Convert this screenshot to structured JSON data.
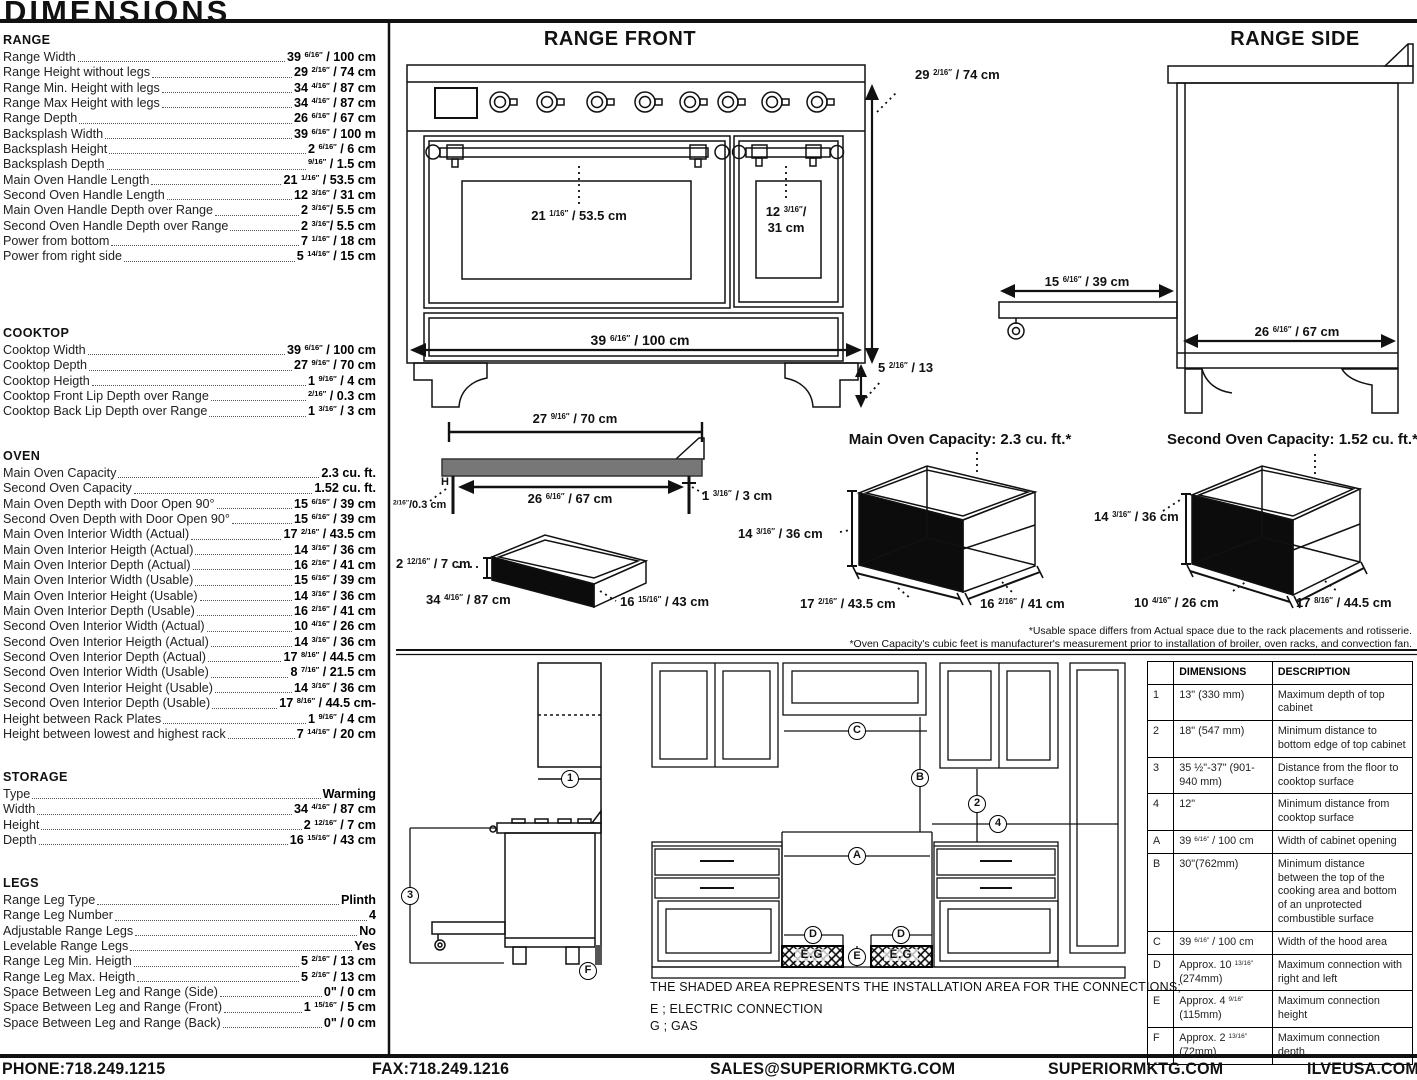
{
  "page": {
    "title": "DIMENSIONS"
  },
  "specs": {
    "sections": [
      {
        "title": "RANGE",
        "rows": [
          {
            "l": "Range Width",
            "v": "39 6/16″ / 100 cm"
          },
          {
            "l": "Range Height without legs",
            "v": "29 2/16″ / 74 cm"
          },
          {
            "l": "Range Min. Height with legs",
            "v": "34 4/16″ / 87 cm"
          },
          {
            "l": "Range Max Height with legs",
            "v": "34 4/16″ / 87 cm"
          },
          {
            "l": "Range Depth",
            "v": "26 6/16″ / 67 cm"
          },
          {
            "l": "Backsplash Width",
            "v": "39 6/16″ / 100 m"
          },
          {
            "l": "Backsplash Height",
            "v": "2 6/16″ / 6 cm"
          },
          {
            "l": "Backsplash Depth",
            "v": "9/16″ / 1.5 cm"
          },
          {
            "l": "Main Oven Handle Length",
            "v": "21 1/16″ / 53.5 cm"
          },
          {
            "l": "Second Oven Handle Length",
            "v": "12 3/16″ / 31 cm"
          },
          {
            "l": "Main Oven Handle Depth over Range",
            "v": "2 3/16″/ 5.5 cm"
          },
          {
            "l": "Second Oven Handle Depth over Range",
            "v": "2 3/16″/ 5.5 cm"
          },
          {
            "l": "Power from bottom",
            "v": "7 1/16″ / 18 cm"
          },
          {
            "l": "Power from right side",
            "v": "5 14/16″ / 15 cm"
          }
        ]
      },
      {
        "title": "COOKTOP",
        "rows": [
          {
            "l": "Cooktop Width",
            "v": "39 6/16″ / 100 cm"
          },
          {
            "l": "Cooktop Depth",
            "v": "27 9/16″ / 70 cm"
          },
          {
            "l": "Cooktop Heigth",
            "v": "1 9/16″ / 4 cm"
          },
          {
            "l": "Cooktop Front Lip Depth over Range",
            "v": "2/16″ / 0.3 cm"
          },
          {
            "l": "Cooktop Back Lip Depth over Range",
            "v": "1 3/16″ / 3 cm"
          }
        ]
      },
      {
        "title": "OVEN",
        "rows": [
          {
            "l": "Main Oven Capacity",
            "v": "2.3 cu. ft."
          },
          {
            "l": "Second Oven Capacity",
            "v": "1.52 cu. ft."
          },
          {
            "l": "Main Oven Depth with Door Open 90°",
            "v": "15 6/16″ / 39 cm"
          },
          {
            "l": "Second Oven Depth with Door Open 90°",
            "v": "15 6/16″ / 39 cm"
          },
          {
            "l": "Main Oven Interior Width (Actual)",
            "v": "17 2/16″ / 43.5 cm"
          },
          {
            "l": "Main Oven Interior Heigth (Actual)",
            "v": "14 3/16″ / 36 cm"
          },
          {
            "l": "Main Oven Interior Depth (Actual)",
            "v": "16 2/16″ / 41 cm"
          },
          {
            "l": "Main Oven Interior Width (Usable)",
            "v": "15 6/16″ / 39 cm"
          },
          {
            "l": "Main Oven Interior Height (Usable)",
            "v": "14 3/16″ / 36 cm"
          },
          {
            "l": "Main Oven Interior Depth (Usable)",
            "v": "16 2/16″ / 41 cm"
          },
          {
            "l": "Second Oven Interior Width (Actual)",
            "v": "10 4/16″ / 26 cm"
          },
          {
            "l": "Second Oven Interior Heigth (Actual)",
            "v": "14 3/16″ / 36 cm"
          },
          {
            "l": "Second Oven Interior Depth (Actual)",
            "v": "17 8/16″ / 44.5 cm"
          },
          {
            "l": "Second Oven Interior Width (Usable)",
            "v": "8 7/16″ / 21.5 cm"
          },
          {
            "l": "Second Oven Interior Height (Usable)",
            "v": "14 3/16″ / 36 cm"
          },
          {
            "l": "Second Oven Interior Depth (Usable)",
            "v": "17 8/16″ / 44.5 cm-"
          },
          {
            "l": "Height between Rack Plates",
            "v": "1 9/16″ / 4 cm"
          },
          {
            "l": "Height between lowest and highest rack",
            "v": "7 14/16″ / 20 cm"
          }
        ]
      },
      {
        "title": "STORAGE",
        "rows": [
          {
            "l": "Type",
            "v": "Warming"
          },
          {
            "l": "Width",
            "v": "34 4/16″ / 87 cm"
          },
          {
            "l": "Height",
            "v": "2 12/16″ / 7 cm"
          },
          {
            "l": "Depth",
            "v": "16 15/16″ / 43 cm"
          }
        ]
      },
      {
        "title": "LEGS",
        "rows": [
          {
            "l": "Range Leg Type",
            "v": "Plinth"
          },
          {
            "l": "Range Leg Number",
            "v": "4"
          },
          {
            "l": "Adjustable Range Legs",
            "v": "No"
          },
          {
            "l": "Levelable Range Legs",
            "v": "Yes"
          },
          {
            "l": "Range Leg Min. Heigth",
            "v": "5 2/16″ / 13 cm"
          },
          {
            "l": "Range Leg Max. Heigth",
            "v": "5 2/16″ / 13 cm"
          },
          {
            "l": "Space Between Leg and Range (Side)",
            "v": "0\" / 0 cm"
          },
          {
            "l": "Space Between Leg and Range (Front)",
            "v": "1 15/16″ / 5 cm"
          },
          {
            "l": "Space Between Leg and Range (Back)",
            "v": "0\" / 0 cm"
          }
        ]
      }
    ]
  },
  "front": {
    "title": "RANGE FRONT",
    "height": "29 2/16″ / 74 cm",
    "main_handle": "21 1/16″ / 53.5 cm",
    "second_handle_a": "12 3/16″/",
    "second_handle_b": "31 cm",
    "width": "39 6/16″ / 100 cm",
    "leg": "5 2/16″ / 13"
  },
  "side": {
    "title": "RANGE SIDE",
    "door": "15 6/16″ / 39 cm",
    "depth": "26 6/16″ / 67 cm"
  },
  "cooktop": {
    "top_width": "27 9/16″ / 70 cm",
    "inner_width": "26 6/16″ / 67 cm",
    "front_lip": "2/16″/0.3 cm",
    "back_lip": "1 3/16″ / 3 cm",
    "h": "H"
  },
  "drawer": {
    "height": "2 12/16″ / 7 cm",
    "width": "34 4/16″ / 87 cm",
    "depth": "16 15/16″ / 43 cm"
  },
  "main_oven": {
    "title": "Main Oven Capacity: 2.3 cu. ft.*",
    "height": "14 3/16″ / 36 cm",
    "width": "17 2/16″ / 43.5 cm",
    "depth": "16 2/16″ / 41 cm"
  },
  "second_oven": {
    "title": "Second Oven Capacity: 1.52 cu. ft.*",
    "height": "14 3/16″ / 36 cm",
    "width": "10 4/16″ / 26 cm",
    "depth": "17 8/16″ / 44.5 cm"
  },
  "footnotes": {
    "line1": "*Usable space differs from Actual space due to the rack placements and rotisserie.",
    "line2": "*Oven Capacity's cubic feet is manufacturer's measurement prior to installation of broiler, oven racks, and convection fan."
  },
  "installation": {
    "note": "THE SHADED AREA REPRESENTS THE INSTALLATION AREA FOR THE CONNECTIONS;",
    "electric": "E ; ELECTRIC CONNECTION",
    "gas": "G ; GAS",
    "markers": {
      "n1": "1",
      "n2": "2",
      "n3": "3",
      "n4": "4",
      "A": "A",
      "B": "B",
      "C": "C",
      "D": "D",
      "E": "E",
      "F": "F",
      "eg": "E.G"
    },
    "table": {
      "col_dim": "DIMENSIONS",
      "col_desc": "DESCRIPTION",
      "rows": [
        {
          "ref": "1",
          "dim": "13\" (330 mm)",
          "desc": "Maximum depth of top cabinet"
        },
        {
          "ref": "2",
          "dim": "18\" (547 mm)",
          "desc": "Minimum distance to bottom edge of top cabinet"
        },
        {
          "ref": "3",
          "dim": "35 ½\"-37\" (901-940 mm)",
          "desc": "Distance from the floor to cooktop surface"
        },
        {
          "ref": "4",
          "dim": "12\"",
          "desc": "Minimum distance from cooktop surface"
        },
        {
          "ref": "A",
          "dim": "39 6/16″ / 100 cm",
          "desc": "Width of cabinet opening"
        },
        {
          "ref": "B",
          "dim": "30\"(762mm)",
          "desc": "Minimum distance between the top of the cooking area and bottom of an unprotected combustible surface"
        },
        {
          "ref": "C",
          "dim": "39 6/16″ / 100 cm",
          "desc": "Width of the hood area"
        },
        {
          "ref": "D",
          "dim": "Approx. 10 13/16″ (274mm)",
          "desc": "Maximum connection with right and left"
        },
        {
          "ref": "E",
          "dim": "Approx. 4 9/16″ (115mm)",
          "desc": "Maximum connection height"
        },
        {
          "ref": "F",
          "dim": "Approx. 2 13/16″ (72mm)",
          "desc": "Maximum connection depth"
        }
      ]
    }
  },
  "footer": {
    "phone": "PHONE:718.249.1215",
    "fax": "FAX:718.249.1216",
    "email": "SALES@SUPERIORMKTG.COM",
    "site": "SUPERIORMKTG.COM",
    "brand": "ILVEUSA.COM"
  }
}
